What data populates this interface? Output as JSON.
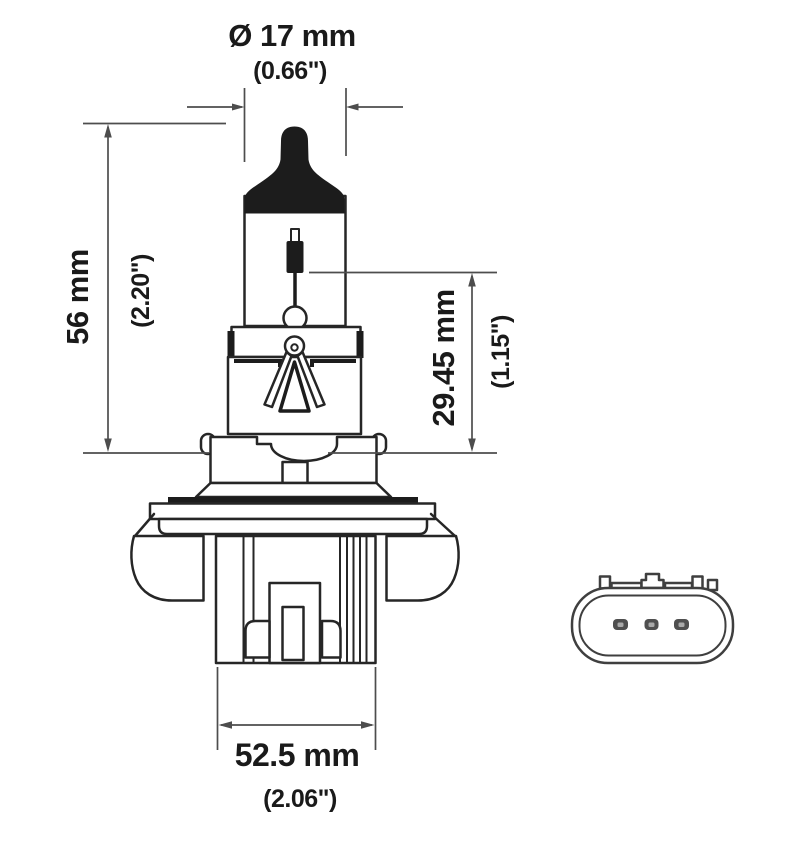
{
  "diagram": {
    "subject": "halogen-bulb-technical-drawing",
    "views": [
      "bulb-front-view",
      "connector-rear-view"
    ],
    "dimensions": {
      "diameter": {
        "metric": "Ø 17 mm",
        "imperial": "(0.66\")"
      },
      "length": {
        "metric": "56 mm",
        "imperial": "(2.20\")"
      },
      "filament": {
        "metric": "29.45 mm",
        "imperial": "(1.15\")"
      },
      "width": {
        "metric": "52.5 mm",
        "imperial": "(2.06\")"
      }
    },
    "connector": {
      "pin_count": 3
    },
    "colors": {
      "outline": "#262626",
      "dimension_line": "#4d4d4d",
      "text": "#1a1a1a",
      "tip_fill": "#1c1c1c",
      "background": "#ffffff"
    }
  }
}
